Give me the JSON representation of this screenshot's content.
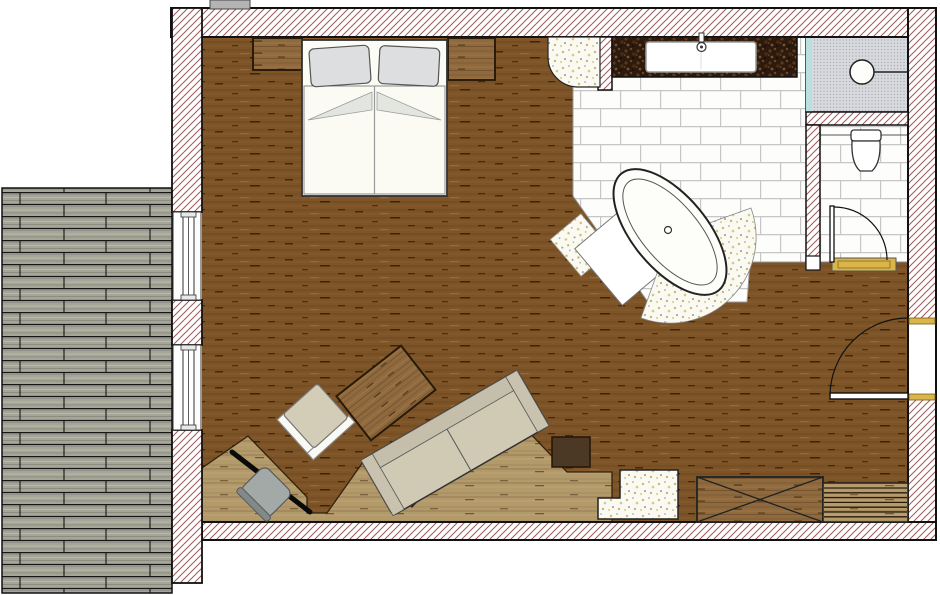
{
  "meta": {
    "type": "architectural-floor-plan",
    "view": "top-down",
    "description": "Studio suite floor plan: bedroom-living room with open bathroom, freestanding bathtub, shower, separate WC and wooden deck terrace"
  },
  "rooms": [
    {
      "id": "bedroom-living",
      "name": "Bedroom / Living Area",
      "floor": "dark wood plank flooring"
    },
    {
      "id": "bathroom",
      "name": "Open Bathroom",
      "floor": "white brick-laid tiles"
    },
    {
      "id": "shower",
      "name": "Shower",
      "features": [
        "glass panel",
        "wall shower head"
      ]
    },
    {
      "id": "wc",
      "name": "Separate WC",
      "features": [
        "toilet",
        "inward swinging door",
        "gold threshold"
      ]
    },
    {
      "id": "terrace",
      "name": "Wood Deck Terrace",
      "floor": "grey decking planks"
    }
  ],
  "furniture": [
    {
      "id": "double-bed",
      "name": "Double bed with two pillows and duvets"
    },
    {
      "id": "nightstand-left",
      "name": "Nightstand left"
    },
    {
      "id": "nightstand-right",
      "name": "Nightstand right"
    },
    {
      "id": "sofa",
      "name": "Sofa (rotated diagonally)"
    },
    {
      "id": "coffee-table",
      "name": "Wooden coffee table (rotated)"
    },
    {
      "id": "armchair",
      "name": "Armchair (rotated)"
    },
    {
      "id": "desk",
      "name": "Diagonal desk in niche"
    },
    {
      "id": "desk-chair",
      "name": "Desk chair"
    },
    {
      "id": "storage-chest",
      "name": "Storage chest with X cross"
    },
    {
      "id": "floor-grate",
      "name": "Slatted floor grate / radiator cover"
    },
    {
      "id": "dark-cabinet",
      "name": "Dark cabinet block"
    },
    {
      "id": "terrazzo-steps",
      "name": "Terrazzo step element"
    },
    {
      "id": "platform",
      "name": "Zig-zag light wood platform"
    }
  ],
  "fixtures": [
    {
      "id": "bathtub",
      "name": "Freestanding oval bathtub with terrazzo apron"
    },
    {
      "id": "vanity",
      "name": "Stone vanity counter with sink and faucet"
    },
    {
      "id": "terrazzo-column",
      "name": "Terrazzo corner element"
    },
    {
      "id": "toilet",
      "name": "Toilet"
    },
    {
      "id": "shower-head",
      "name": "Shower head symbol"
    },
    {
      "id": "bath-mats",
      "name": "Bath mats beside tub"
    }
  ],
  "openings": [
    {
      "id": "window-1",
      "name": "Terrace window upper",
      "wall": "left"
    },
    {
      "id": "window-2",
      "name": "Terrace window lower",
      "wall": "left"
    },
    {
      "id": "door-right",
      "name": "Entry door",
      "wall": "right",
      "swing": "into room"
    },
    {
      "id": "door-wc",
      "name": "WC door",
      "swing": "into WC"
    }
  ],
  "colors": {
    "wood": "#7d5427",
    "wood-grain-dark": "#45280e",
    "lightwood": "#b39a6a",
    "midwood": "#8f6a3f",
    "deck": "#a6a698",
    "hatch": "#a05858",
    "wall-line": "#111111",
    "tile-joint": "#c6c6c6",
    "tile-bg": "#fdfdfc",
    "terrazzo-bg": "#fbfaf2",
    "terrazzo-dot": "#c6bd6e",
    "gold": "#d9b54a",
    "glass-teal": "#badfe0",
    "stipple-bg": "#d8dade",
    "darkstone": "#2c1a0e",
    "sofa-beige": "#d0cab4",
    "pillow-grey": "#dcdee0",
    "chair-grey": "#a2a9a7",
    "dark-cabinet": "#4b3926",
    "white-fixture": "#fdfdfa"
  }
}
